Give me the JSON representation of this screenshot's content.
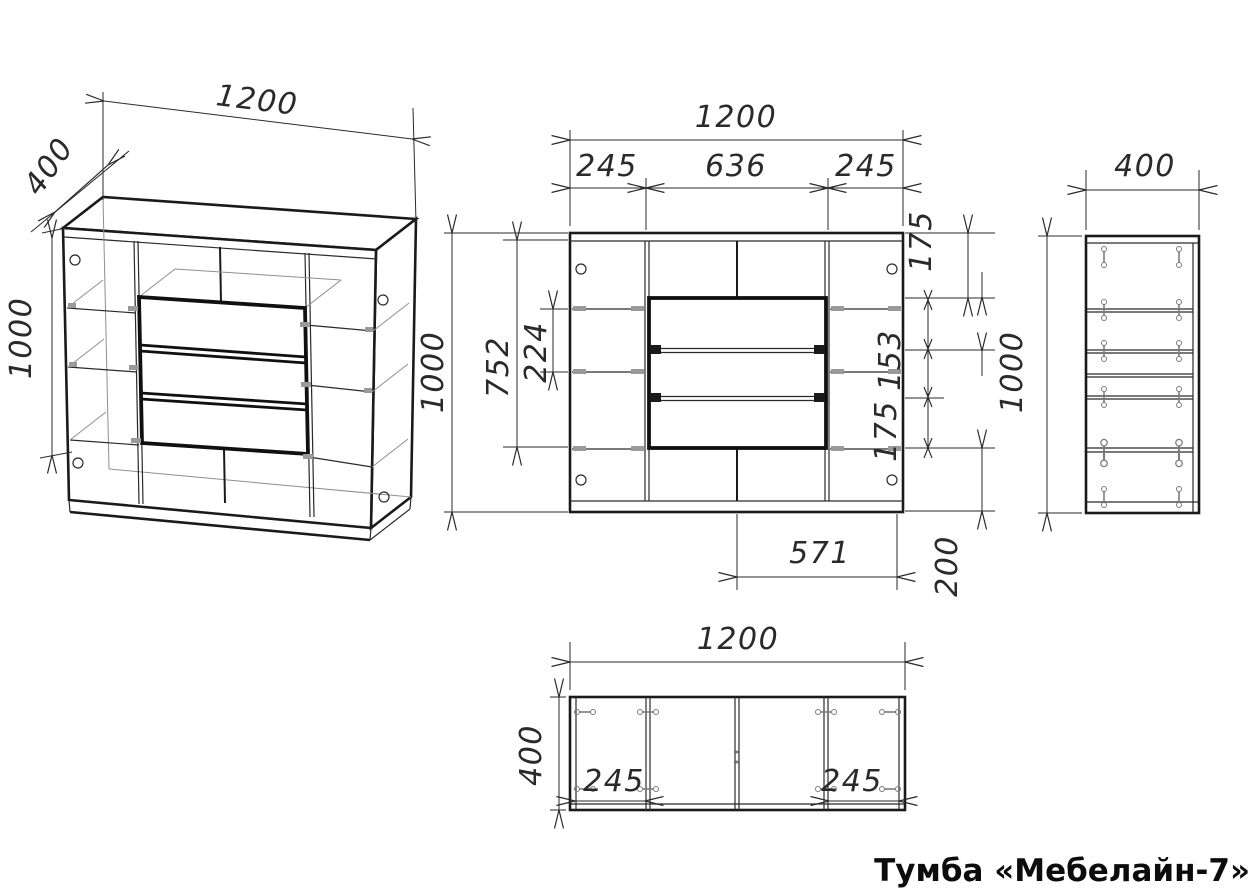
{
  "title": "Тумба «Мебелайн-7»",
  "iso": {
    "width": "1200",
    "depth": "400",
    "height": "1000"
  },
  "front": {
    "width": "1200",
    "left_section": "245",
    "center_section": "636",
    "right_section": "245",
    "height": "1000",
    "inner_height": "752",
    "shelf_gap": "224",
    "top_gap": "175",
    "drawer_gap_upper": "153",
    "drawer_gap_lower": "175",
    "bottom_gap": "200",
    "drawer_width": "571"
  },
  "side": {
    "depth": "400",
    "height": "1000"
  },
  "top_view": {
    "width": "1200",
    "depth": "400",
    "left_section": "245",
    "right_section": "245"
  }
}
